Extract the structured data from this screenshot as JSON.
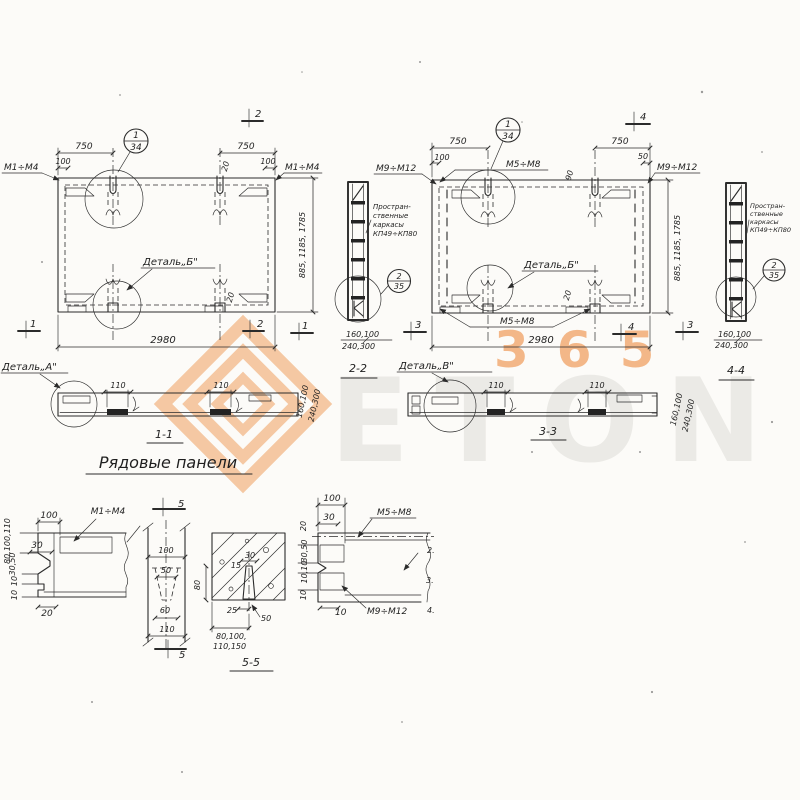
{
  "watermark": {
    "brand": "ETON",
    "number": "365"
  },
  "plan1": {
    "balloon_num": "1",
    "balloon_den": "34",
    "mark_left": "М1÷М4",
    "mark_right": "М1÷М4",
    "dim_750_left": "750",
    "dim_100_left": "100",
    "dim_750_right": "750",
    "dim_100_right": "100",
    "dim_20_top": "20",
    "dim_20_bottom": "20",
    "detail_b": "Деталь„Б\"",
    "dim_width": "2980",
    "dim_height": "885, 1185, 1785",
    "sec_top": "2",
    "sec_bottom": "2",
    "sec_left": "1",
    "sec_right": "1"
  },
  "cage1": {
    "note1": "Простран-",
    "note2": "ственные",
    "note3": "каркасы",
    "note4": "КП49÷КП80",
    "balloon_num": "2",
    "balloon_den": "35",
    "dim_top": "160,100",
    "dim_bottom": "240,300"
  },
  "plan2": {
    "balloon_num": "1",
    "balloon_den": "34",
    "mark_topleft": "М9÷М12",
    "mark_top": "М5÷М8",
    "mark_topright": "М9÷М12",
    "mark_bottom": "М5÷М8",
    "dim_750_left": "750",
    "dim_100_left": "100",
    "dim_750_right": "750",
    "dim_50_right": "50",
    "dim_90": "90",
    "dim_20_bottom": "20",
    "detail_b": "Деталь„Б\"",
    "dim_width": "2980",
    "dim_height": "885, 1185, 1785",
    "sec_top": "4",
    "sec_bottom": "4",
    "sec_left": "3",
    "sec_right": "3"
  },
  "cage2": {
    "note1": "Простран-",
    "note2": "ственные",
    "note3": "каркасы",
    "note4": "КП49÷КП80",
    "balloon_num": "2",
    "balloon_den": "35",
    "dim_top": "160,100",
    "dim_bottom": "240,300"
  },
  "sections": {
    "detail_a": "Деталь„А\"",
    "detail_v": "Деталь„В\"",
    "s11_label": "1-1",
    "s11_d110a": "110",
    "s11_d110b": "110",
    "title": "Рядовые панели",
    "s22_label": "2-2",
    "s22_rot1": "160,100",
    "s22_rot2": "240,300",
    "s33_label": "3-3",
    "s33_d110a": "110",
    "s33_d110b": "110",
    "s33_rot1": "160,100",
    "s33_rot2": "240,300",
    "s44_label": "4-4"
  },
  "det_left": {
    "d100": "100",
    "mark": "М1÷М4",
    "d30": "30",
    "rot1": "80,100,110",
    "rot2": "30,50",
    "rot3": "10",
    "rot4": "10",
    "d20": "20"
  },
  "det_mid": {
    "sec_top": "5",
    "sec_bottom": "5",
    "d100": "100",
    "d50": "50",
    "d60": "60",
    "d110": "110"
  },
  "s55": {
    "d30": "30",
    "d15": "15",
    "d80": "80",
    "d25": "25",
    "d50": "50",
    "dims1": "80,100,",
    "dims2": "110,150",
    "label": "5-5"
  },
  "det_right": {
    "d100": "100",
    "d30": "30",
    "rot20": "20",
    "mark_top": "М5÷М8",
    "rot1": "30,50",
    "rot2": "10,10",
    "rot3": "10",
    "d10": "10",
    "mark_bottom": "М9÷М12",
    "n2": "2.",
    "n3": "3.",
    "n4": "4."
  }
}
